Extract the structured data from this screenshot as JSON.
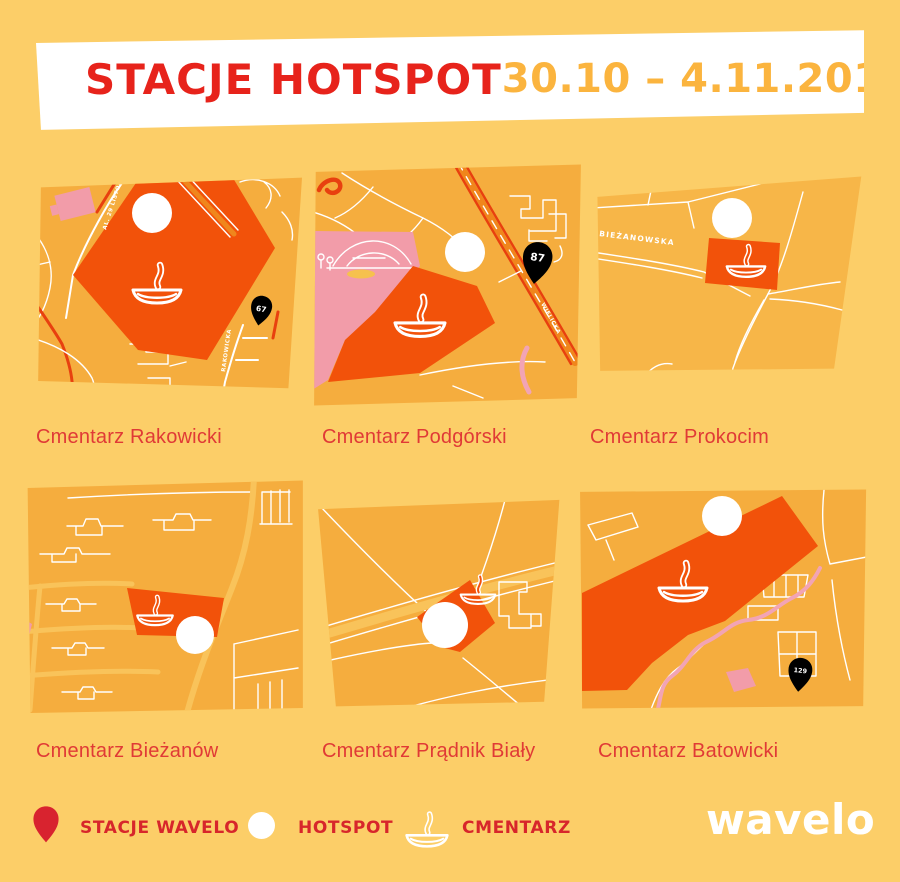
{
  "header": {
    "title": "STACJE HOTSPOT",
    "date_range": "30.10 – 4.11.2019"
  },
  "tiles": [
    {
      "label": "Cmentarz Rakowicki",
      "streets": {
        "a": "AL. 29 LISTOPADA",
        "b": "RAKOWICKA"
      },
      "pin": "67"
    },
    {
      "label": "Cmentarz Podgórski",
      "streets": {
        "a": "WIELICKA"
      },
      "pin": "87"
    },
    {
      "label": "Cmentarz Prokocim",
      "streets": {
        "a": "BIEŻANOWSKA"
      }
    },
    {
      "label": "Cmentarz Bieżanów"
    },
    {
      "label": "Cmentarz Prądnik Biały"
    },
    {
      "label": "Cmentarz Batowicki",
      "pin": "129"
    }
  ],
  "legend": {
    "station_label": "STACJE WAVELO",
    "hotspot_label": "HOTSPOT",
    "cemetery_label": "CMENTARZ"
  },
  "logo_text": "wavelo",
  "colors": {
    "page_bg": "#FCCE68",
    "tile_bg": "#F5AD3E",
    "banner_bg": "#FFFFFF",
    "title_red": "#E7231B",
    "date_orange": "#FBB43E",
    "label_red": "#E03A36",
    "legend_red": "#D7262B",
    "cemetery_orange": "#F2520A",
    "pin_red": "#D8232F",
    "pink": "#F29CA9",
    "hotspot_white": "#FFFFFF"
  }
}
